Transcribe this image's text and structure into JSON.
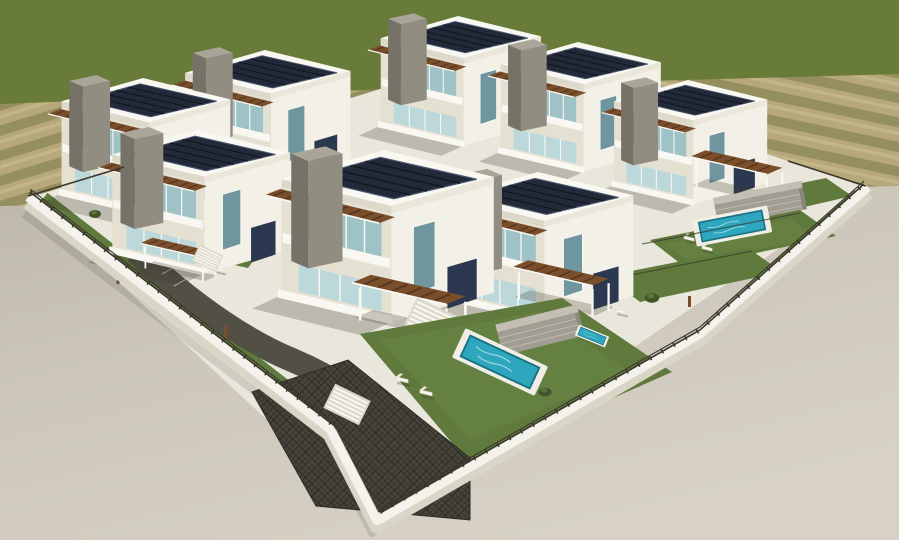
{
  "meta": {
    "title": "Aerial 3D architectural rendering of a modern villa complex",
    "width_px": 899,
    "height_px": 540
  },
  "scene": {
    "villa_count": 8,
    "pool_count": 4,
    "lounger_pairs": 6,
    "elements": [
      "white two-storey villas",
      "rooftop solar panels",
      "wooden pergolas",
      "glass balconies",
      "private lawns with pools",
      "stone accent walls",
      "white perimeter wall with dark fence",
      "dark paver driveway and stairs",
      "striped farmland backdrop",
      "green hillside horizon",
      "grey concrete surroundings"
    ]
  },
  "palette": {
    "grass": "#687b39",
    "fieldTan": "#b6a87a",
    "fieldRow": "#8f8a58",
    "fieldLight": "#c9bb8c",
    "pavement": "#ccc7ba",
    "pavementDark": "#bdb8aa",
    "pavementLight": "#d7d2c5",
    "lot": "#e9e6dc",
    "lawn": "#5f7a3c",
    "lawnLight": "#73904b",
    "white": "#f8f7f1",
    "fascia": "#dcd8ca",
    "fasciaLight": "#eae6d9",
    "wallShade": "#e4e0d2",
    "wallLight": "#f3f0e7",
    "wallTop": "#f4f2ea",
    "wallFace": "#d9d5c7",
    "fence": "#3a372e",
    "solar": "#222938",
    "solarLine": "#11161f",
    "solarFrame": "#4d5870",
    "glass": "#9fc2c7",
    "glassLight": "#bcd8da",
    "glassDark": "#6f959e",
    "wood": "#7b4e2b",
    "woodDark": "#55371d",
    "towerTop": "#a9a599",
    "towerMid": "#918d81",
    "towerDark": "#767268",
    "accentNavy": "#2b3850",
    "pool": "#2ea7be",
    "poolRim": "#177183",
    "poolRipple": "#a5e0ea",
    "deck": "#f0eee6",
    "stone": "#a19d92",
    "stoneLight": "#c3bfb4",
    "stoneDark": "#8a867b",
    "pavers": "#47443b",
    "paversLine": "#2d2b25",
    "ramp": "#524f44",
    "shrub": "#42552a",
    "shadow": "#3c3a30"
  }
}
